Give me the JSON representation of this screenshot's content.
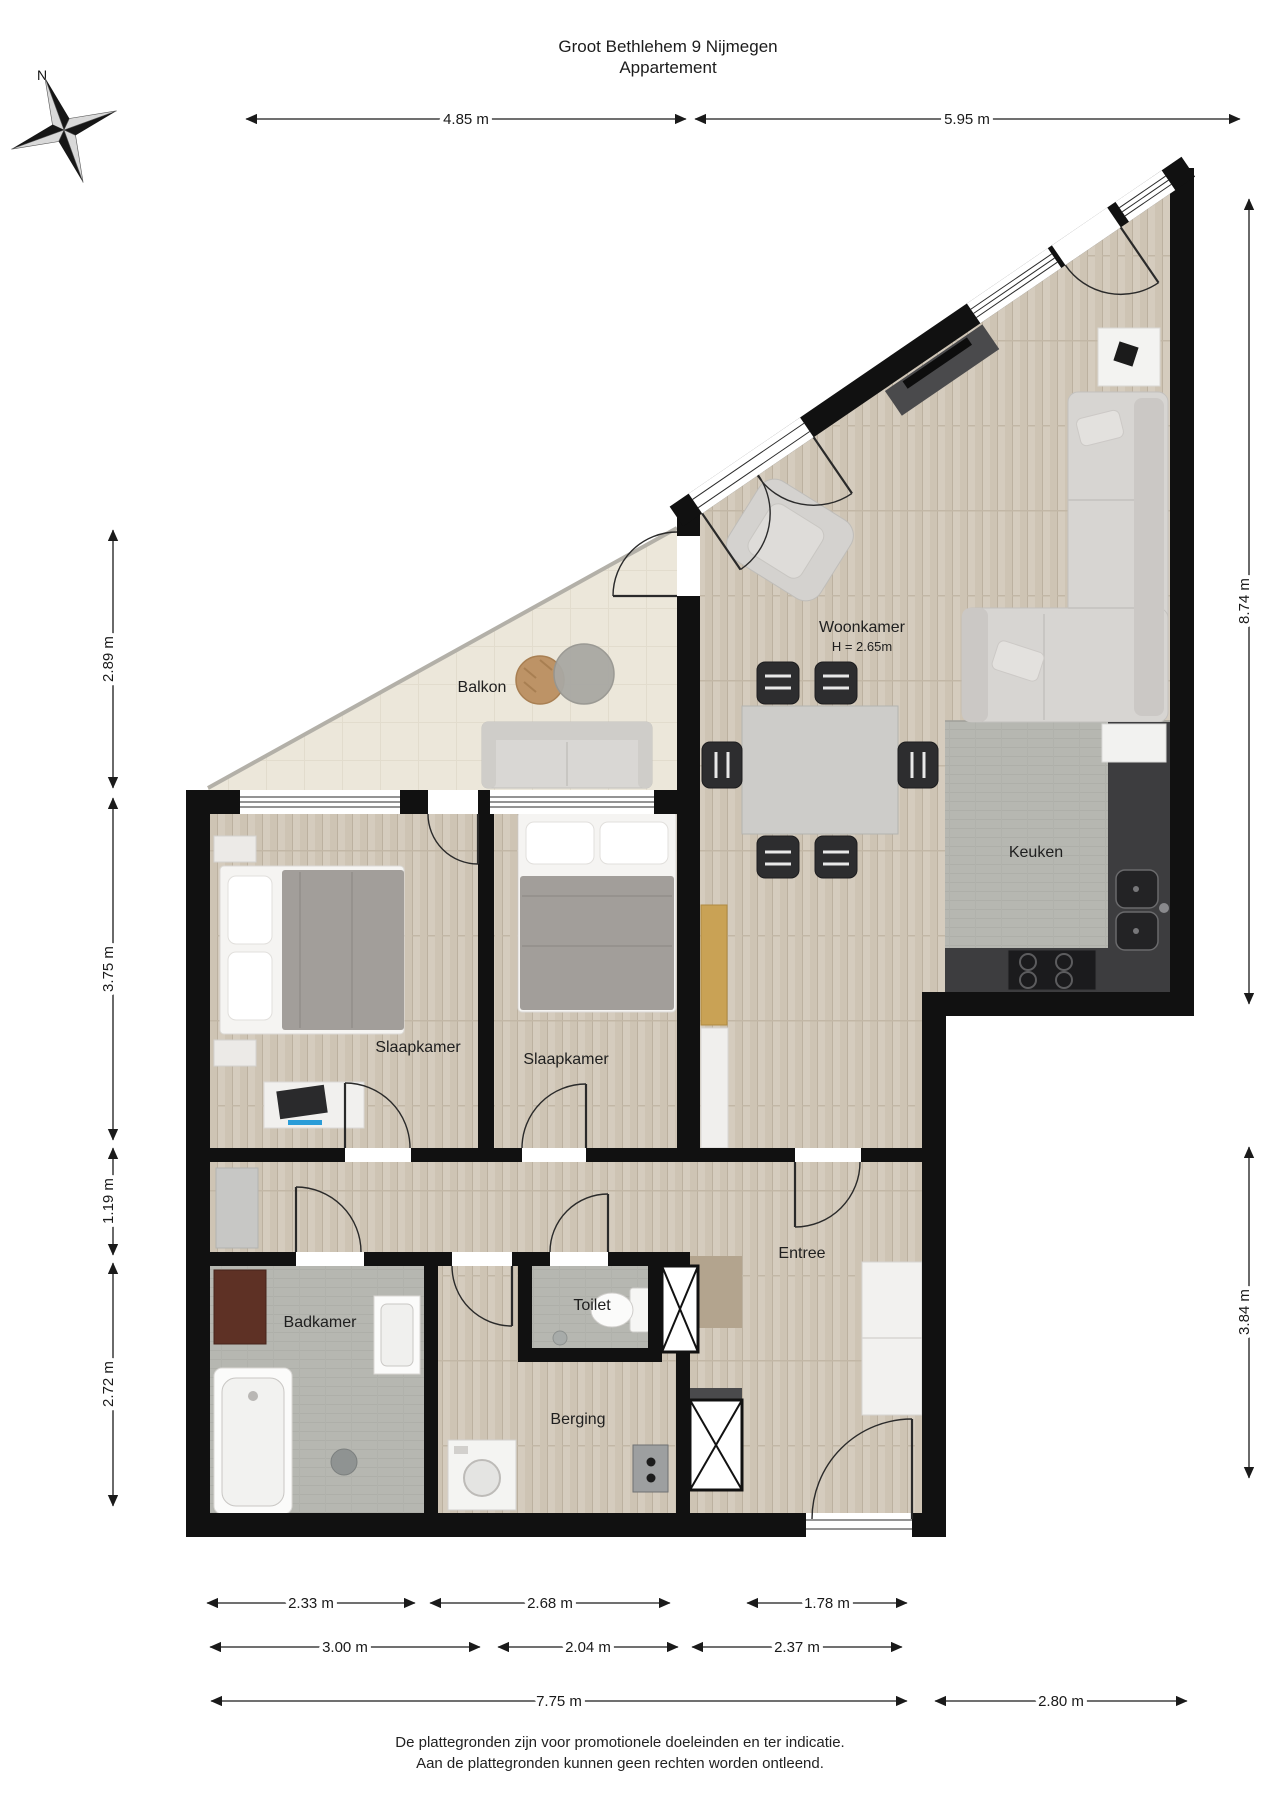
{
  "title": {
    "line1": "Groot Bethlehem 9 Nijmegen",
    "line2": "Appartement"
  },
  "compass": {
    "north": "N"
  },
  "rooms": {
    "balkon": {
      "name": "Balkon"
    },
    "woonkamer": {
      "name": "Woonkamer",
      "height": "H = 2.65m"
    },
    "keuken": {
      "name": "Keuken"
    },
    "slaapkamer_links": {
      "name": "Slaapkamer"
    },
    "slaapkamer_midden": {
      "name": "Slaapkamer"
    },
    "badkamer": {
      "name": "Badkamer"
    },
    "toilet": {
      "name": "Toilet"
    },
    "berging": {
      "name": "Berging"
    },
    "entree": {
      "name": "Entree"
    }
  },
  "dimensions": {
    "top": [
      "4.85 m",
      "5.95 m"
    ],
    "left": [
      "2.89 m",
      "3.75 m",
      "1.19 m",
      "2.72 m"
    ],
    "right": [
      "8.74 m",
      "3.84 m"
    ],
    "bottom_row1": [
      "2.33 m",
      "2.68 m",
      "1.78 m"
    ],
    "bottom_row2": [
      "3.00 m",
      "2.04 m",
      "2.37 m"
    ],
    "bottom_row3": [
      "7.75 m",
      "2.80 m"
    ]
  },
  "footer": {
    "line1": "De plattegronden zijn voor promotionele doeleinden en ter indicatie.",
    "line2": "Aan de plattegronden kunnen geen rechten worden ontleend."
  },
  "colors": {
    "wall": "#111111",
    "wood_floor": "#d3c9ba",
    "tile_floor": "#b6b7b1",
    "balcony_floor": "#ece7da",
    "counter_dark": "#3d3d3f",
    "accent_blue": "#2a9cd8"
  }
}
